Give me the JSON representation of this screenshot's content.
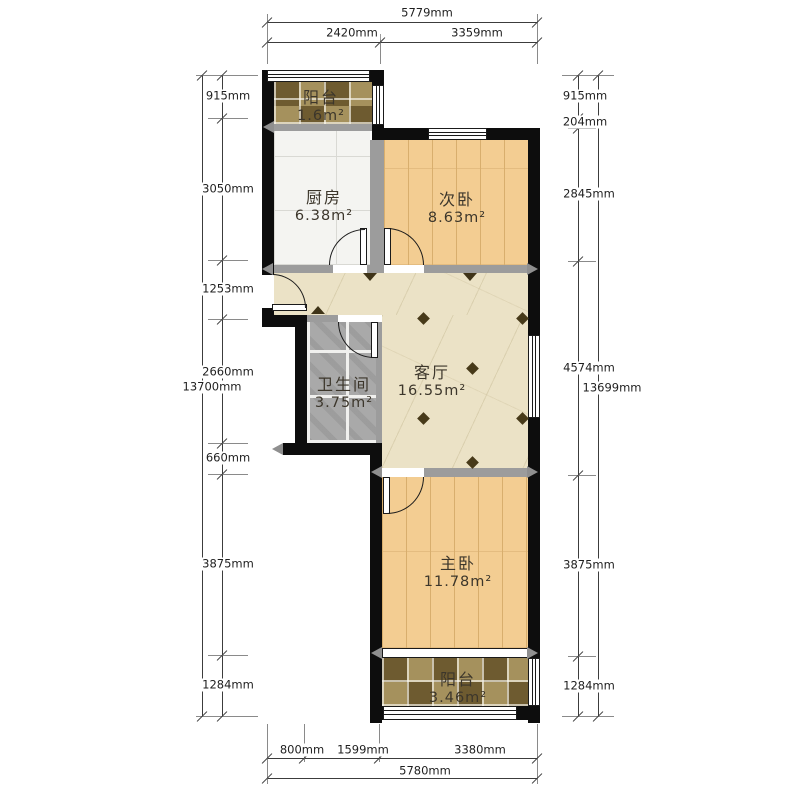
{
  "plan": {
    "type": "apartment-floor-plan",
    "unit": "mm"
  },
  "rooms": [
    {
      "id": "balcony-top",
      "name": "阳台",
      "area": "1.6m²"
    },
    {
      "id": "kitchen",
      "name": "厨房",
      "area": "6.38m²"
    },
    {
      "id": "bedroom-second",
      "name": "次卧",
      "area": "8.63m²"
    },
    {
      "id": "living-room",
      "name": "客厅",
      "area": "16.55m²"
    },
    {
      "id": "bathroom",
      "name": "卫生间",
      "area": "3.75m²"
    },
    {
      "id": "bedroom-master",
      "name": "主卧",
      "area": "11.78m²"
    },
    {
      "id": "balcony-bottom",
      "name": "阳台",
      "area": "3.46m²"
    }
  ],
  "dimensions": {
    "top": {
      "total": "5779mm",
      "segments": [
        "2420mm",
        "3359mm"
      ]
    },
    "bottom": {
      "total": "5780mm",
      "segments": [
        "800mm",
        "1599mm",
        "3380mm"
      ]
    },
    "left": {
      "total": "13700mm",
      "segments": [
        "915mm",
        "3050mm",
        "1253mm",
        "2660mm",
        "660mm",
        "3875mm",
        "1284mm"
      ]
    },
    "right": {
      "total": "13699mm",
      "segments": [
        "915mm",
        "204mm",
        "2845mm",
        "4574mm",
        "3875mm",
        "1284mm"
      ]
    }
  },
  "colors": {
    "wall_exterior": "#0d0d0d",
    "wall_partition": "#9c9c9c",
    "floor_wood": "#f3cd92",
    "floor_living": "#ebe2c6",
    "floor_bath_tile": "#a9a9a9",
    "floor_balcony_tile": "#8a7544",
    "floor_kitchen_tile": "#f4f4f1",
    "accent_diamond": "#473a19",
    "background": "#ffffff"
  }
}
